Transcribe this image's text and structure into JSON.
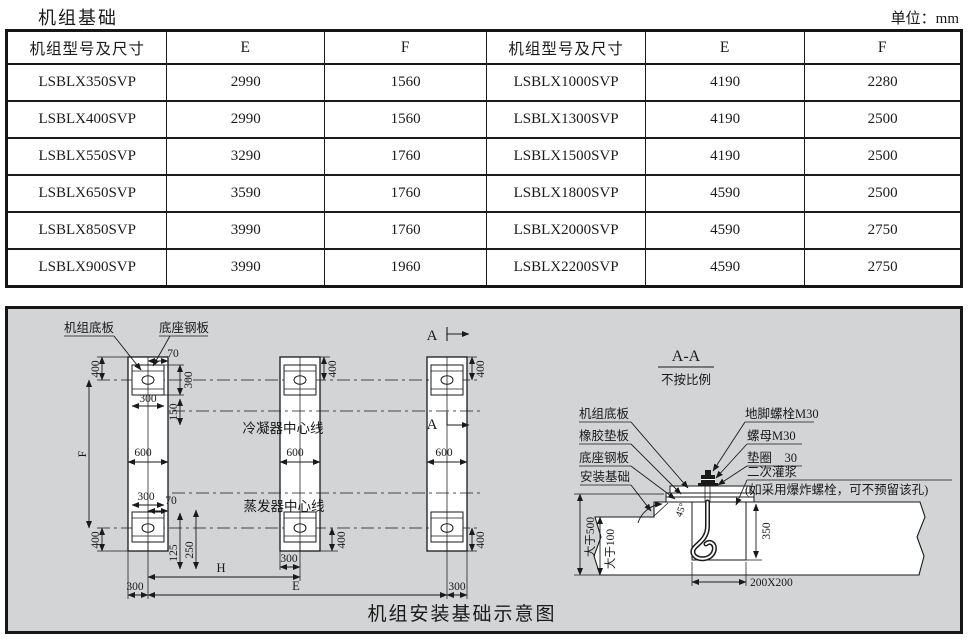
{
  "page": {
    "title": "机组基础",
    "unit_label": "单位：mm"
  },
  "table": {
    "headers": [
      "机组型号及尺寸",
      "E",
      "F",
      "机组型号及尺寸",
      "E",
      "F"
    ],
    "rows": [
      [
        "LSBLX350SVP",
        "2990",
        "1560",
        "LSBLX1000SVP",
        "4190",
        "2280"
      ],
      [
        "LSBLX400SVP",
        "2990",
        "1560",
        "LSBLX1300SVP",
        "4190",
        "2500"
      ],
      [
        "LSBLX550SVP",
        "3290",
        "1760",
        "LSBLX1500SVP",
        "4190",
        "2500"
      ],
      [
        "LSBLX650SVP",
        "3590",
        "1760",
        "LSBLX1800SVP",
        "4590",
        "2500"
      ],
      [
        "LSBLX850SVP",
        "3990",
        "1760",
        "LSBLX2000SVP",
        "4590",
        "2750"
      ],
      [
        "LSBLX900SVP",
        "3990",
        "1960",
        "LSBLX2200SVP",
        "4590",
        "2750"
      ]
    ]
  },
  "diagram": {
    "caption": "机组安装基础示意图",
    "plan": {
      "unit_base_plate": "机组底板",
      "base_steel_plate": "底座钢板",
      "condenser_centerline": "冷凝器中心线",
      "evaporator_centerline": "蒸发器中心线",
      "section_letter": "A",
      "dims": {
        "d70": "70",
        "d400": "400",
        "d300": "300",
        "d150": "150",
        "d600": "600",
        "d125": "125",
        "d250": "250",
        "f": "F",
        "h": "H",
        "e": "E"
      }
    },
    "section": {
      "title": "A-A",
      "note_scale": "不按比例",
      "unit_base_plate": "机组底板",
      "rubber_pad": "橡胶垫板",
      "base_steel_plate": "底座钢板",
      "install_foundation": "安装基础",
      "anchor_bolt": "地脚螺栓M30",
      "nut": "螺母M30",
      "washer": "垫圈　30",
      "grout": "二次灌浆",
      "grout_note": "(如采用爆炸螺栓，可不预留该孔)",
      "dims": {
        "gt500": "大于500",
        "gt100": "大于100",
        "d350": "350",
        "pocket": "200X200",
        "angle": "45°"
      }
    }
  }
}
